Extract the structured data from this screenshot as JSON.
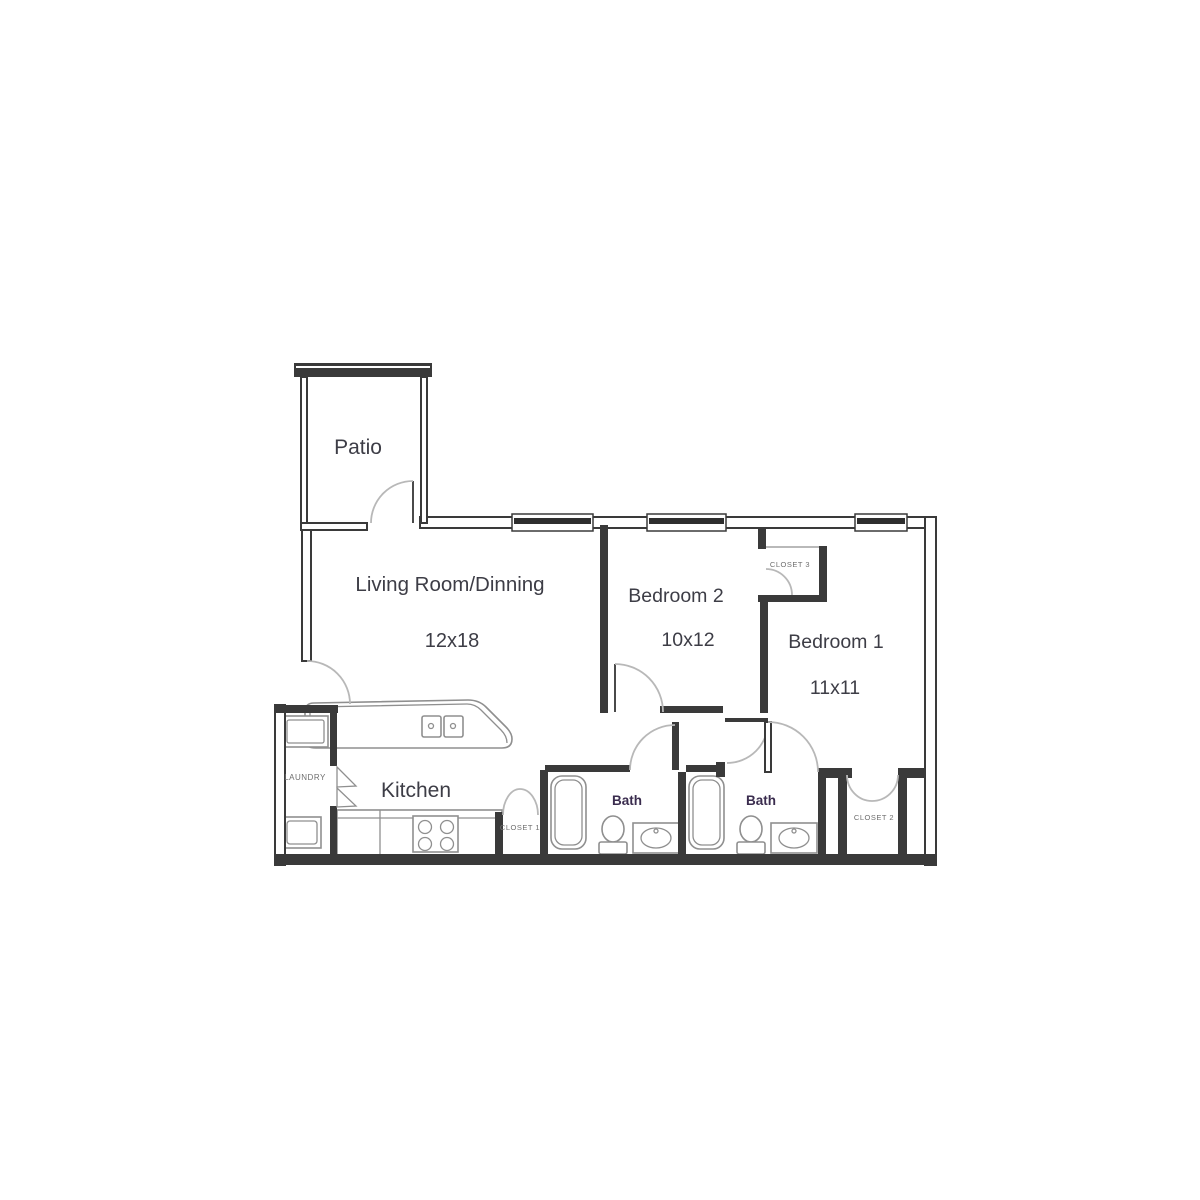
{
  "image_type": "apartment-floor-plan",
  "rooms": {
    "patio": {
      "name": "Patio"
    },
    "living": {
      "name": "Living Room/Dinning",
      "dims": "12x18"
    },
    "bedroom2": {
      "name": "Bedroom 2",
      "dims": "10x12"
    },
    "bedroom1": {
      "name": "Bedroom 1",
      "dims": "11x11"
    },
    "kitchen": {
      "name": "Kitchen"
    },
    "laundry": {
      "name": "LAUNDRY"
    },
    "bath1": {
      "name": "Bath"
    },
    "bath2": {
      "name": "Bath"
    },
    "closet1": {
      "name": "CLOSET 1"
    },
    "closet2": {
      "name": "CLOSET 2"
    },
    "closet3": {
      "name": "CLOSET 3"
    }
  },
  "colors": {
    "background": "#ffffff",
    "wall": "#3a3a3a",
    "door_arc": "#b8b8b8",
    "fixture": "#8f8f8f",
    "room_label": "#3d3d46",
    "bath_label": "#3a2c4e",
    "closet_label": "#6e6e6e"
  }
}
